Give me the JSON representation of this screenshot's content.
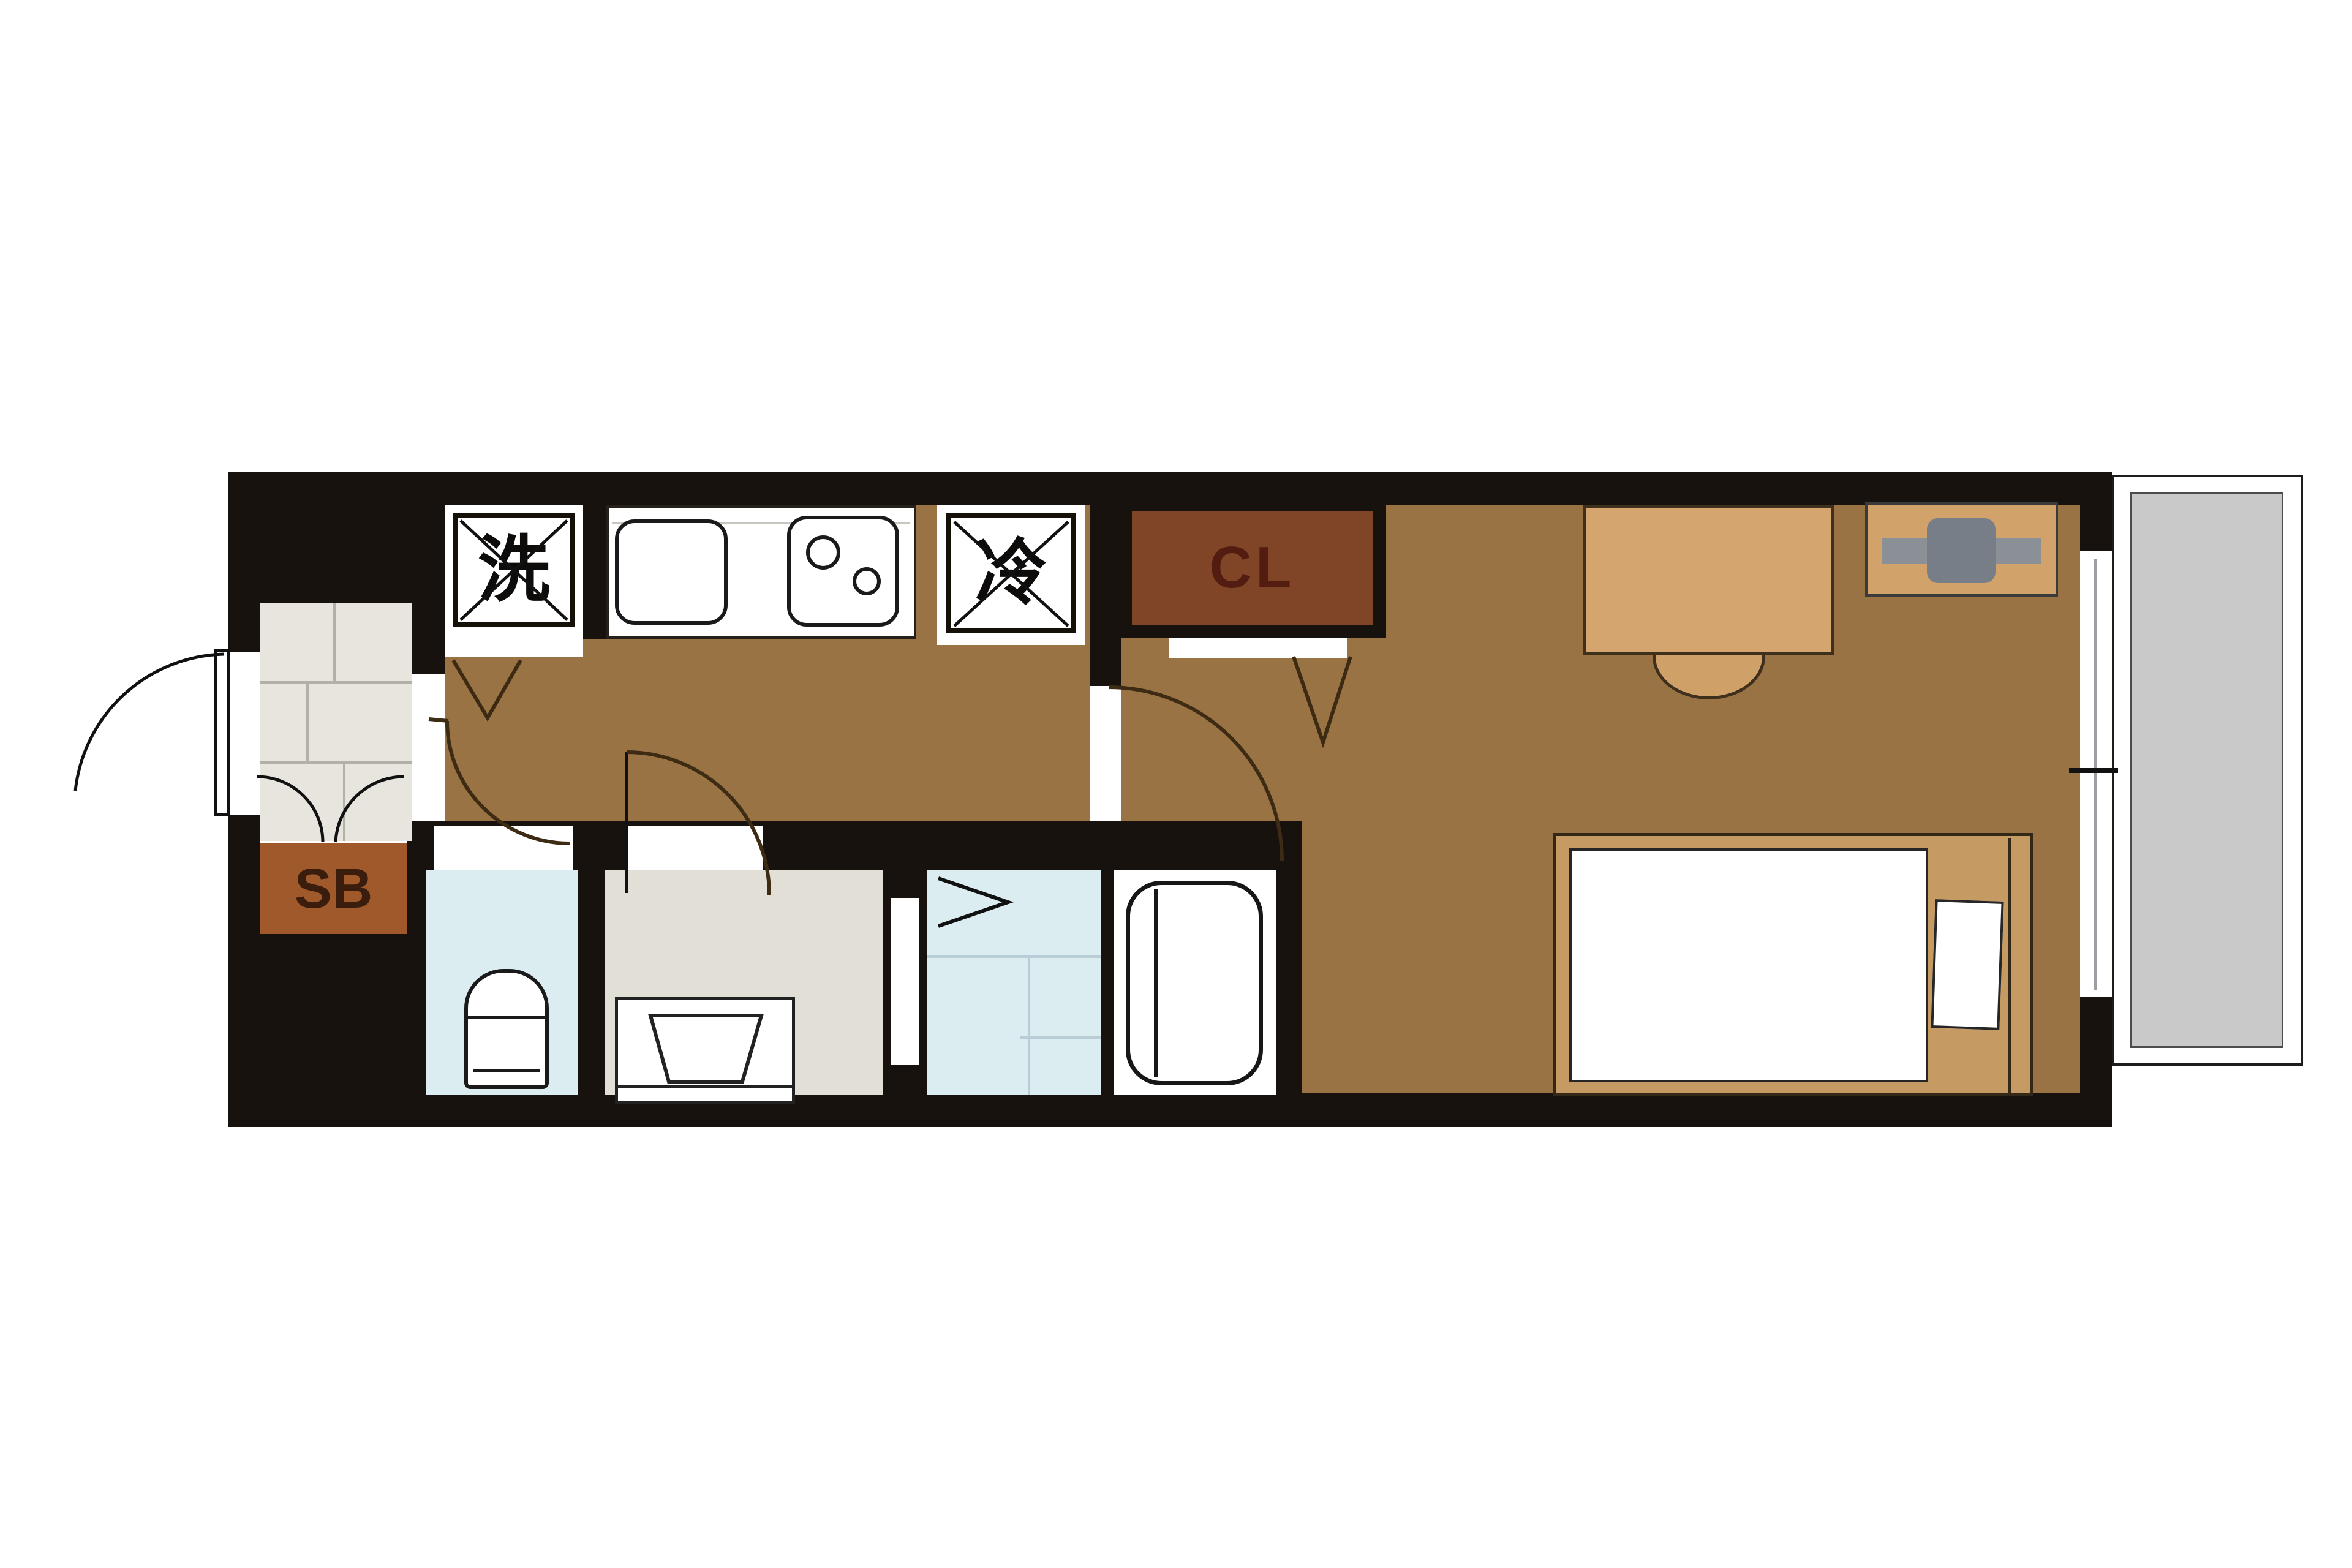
{
  "floorplan": {
    "labels": {
      "washer": "洗",
      "fridge": "冷",
      "closet": "CL",
      "shoebox": "SB"
    },
    "colors": {
      "wall": "#17120e",
      "floor_wood": "#9a7345",
      "closet_fill": "#7f4526",
      "closet_text": "#531c10",
      "shoebox_fill": "#a0592b",
      "shoebox_text": "#3a1d0c",
      "genkan_tile": "#e8e5de",
      "wet_area_blue": "#dcedf2",
      "washroom_gray": "#e2dfd7",
      "balcony_gray": "#c9c9c9",
      "furniture_tan": "#d2a26b",
      "bed_frame_tan": "#c69a63",
      "aircon_gray": "#8b9096"
    }
  }
}
